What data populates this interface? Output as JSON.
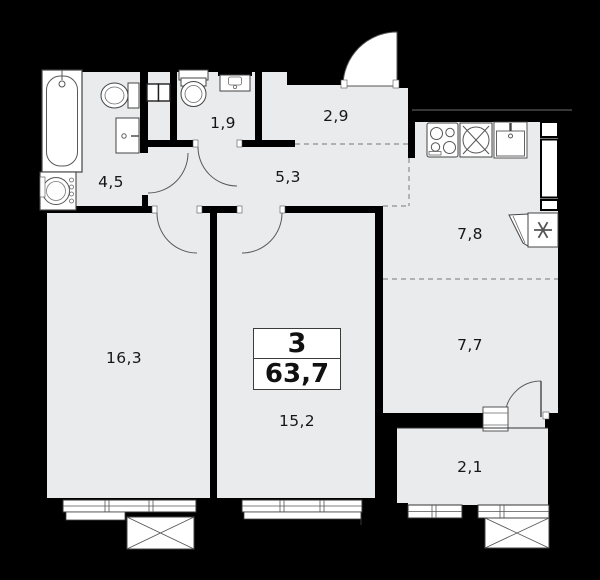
{
  "unit": {
    "rooms_count": "3",
    "total_area": "63,7"
  },
  "room_areas": {
    "bathroom": "4,5",
    "wc": "1,9",
    "hall": "2,9",
    "corridor": "5,3",
    "kitchen": "7,8",
    "kitchen_zone": "7,7",
    "bedroom": "16,3",
    "living_room": "15,2",
    "balcony": "2,1"
  },
  "colors": {
    "background": "#000000",
    "floor": "#e9ebed",
    "wall": "#000000",
    "fixture_line": "#4a4a4a",
    "dashed_zone_line": "#8f8f8f"
  }
}
